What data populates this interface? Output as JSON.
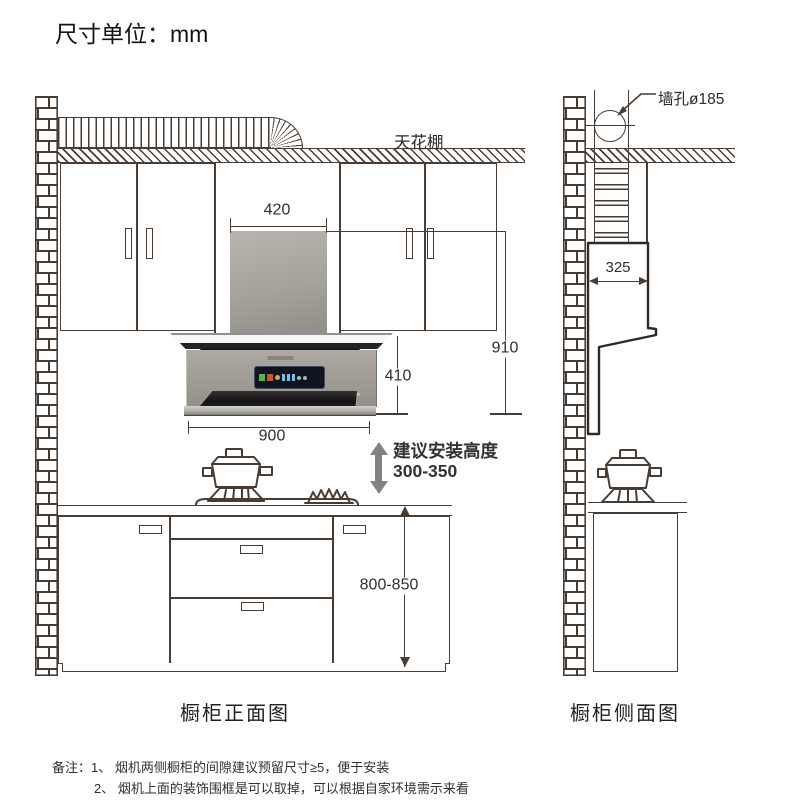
{
  "unit_title": "尺寸单位：mm",
  "front_view": {
    "ceiling_label": "天花棚",
    "dim_chimney_width": "420",
    "dim_total_height": "910",
    "dim_hood_height": "410",
    "dim_hood_width": "900",
    "dim_counter_height": "800-850",
    "install_height_label": "建议安装高度",
    "install_height_range": "300-350",
    "caption": "橱柜正面图"
  },
  "side_view": {
    "wall_hole_label": "墙孔ø185",
    "dim_depth": "325",
    "caption": "橱柜侧面图"
  },
  "notes": {
    "line1": "备注：1、 烟机两侧橱柜的间隙建议预留尺寸≥5，便于安装",
    "line2": "2、 烟机上面的装饰围框是可以取掉，可以根据自家环境需示来看"
  },
  "colors": {
    "line": "#473d35",
    "profile_line": "#2f2a26",
    "hood_body_gray": "#9b9790",
    "chimney_gray": "#a7a49d",
    "arrow_gray": "#828282"
  }
}
